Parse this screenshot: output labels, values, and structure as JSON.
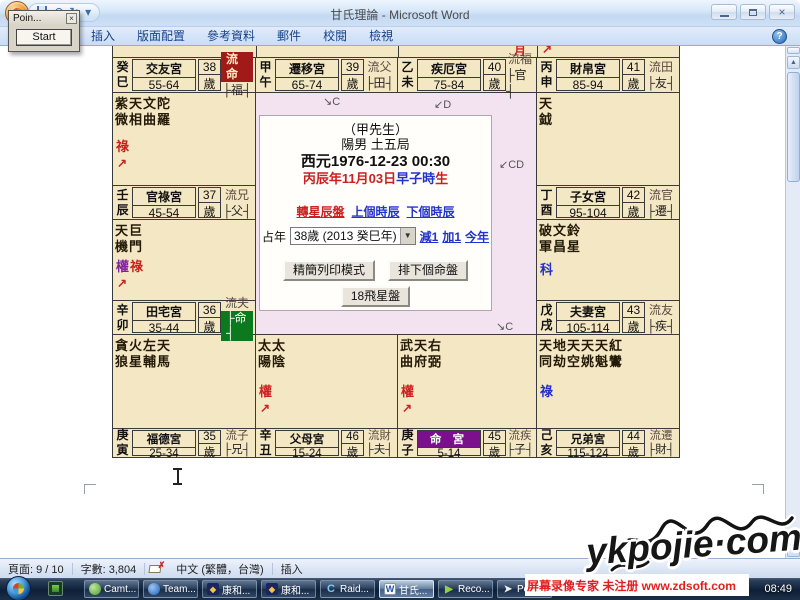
{
  "window": {
    "title": "甘氏理論 - Microsoft Word"
  },
  "popup": {
    "title": "Poin...",
    "start_button": "Start"
  },
  "ribbon": {
    "tabs": [
      "插入",
      "版面配置",
      "參考資料",
      "郵件",
      "校閱",
      "檢視"
    ],
    "help": "?"
  },
  "icons": {
    "undo": "↶",
    "redo": "↻",
    "qat_more": "▾",
    "close": "×",
    "popup_close": "×",
    "select_dropdown": "▼",
    "scroll_up": "▲",
    "scroll_down": "▼",
    "proofing_x": "✗",
    "kanghe_glyph": "◆",
    "raid_glyph": "C",
    "word_glyph": "W",
    "recorder_glyph": "▶",
    "pointer_glyph": "➤"
  },
  "chart": {
    "colors": {
      "cell_bg": "#f4e7c3",
      "center_bg": "#f3e3f1",
      "liu_highlight": "#a11a1a",
      "tag_highlight": "#0b7a1f",
      "name_highlight": "#7b0f8e"
    },
    "overflow_marks": [
      "月",
      "↗"
    ],
    "fly_marks": [
      "↘C",
      "↙D",
      "↙CD",
      "↘C"
    ],
    "palaces": [
      {
        "stem": "癸",
        "branch": "巳",
        "name": "交友宮",
        "range": "55-64",
        "age": "38",
        "age_unit": "歲",
        "liu": "流命",
        "liu_highlight": true,
        "tag": "├福┤"
      },
      {
        "stem": "甲",
        "branch": "午",
        "name": "遷移宮",
        "range": "65-74",
        "age": "39",
        "age_unit": "歲",
        "liu": "流父",
        "tag": "├田┤"
      },
      {
        "stem": "乙",
        "branch": "未",
        "name": "疾厄宮",
        "range": "75-84",
        "age": "40",
        "age_unit": "歲",
        "liu": "流福",
        "tag": "├官┤"
      },
      {
        "stem": "丙",
        "branch": "申",
        "name": "財帛宮",
        "range": "85-94",
        "age": "41",
        "age_unit": "歲",
        "liu": "流田",
        "tag": "├友┤"
      },
      {
        "stem": "壬",
        "branch": "辰",
        "name": "官祿宮",
        "range": "45-54",
        "age": "37",
        "age_unit": "歲",
        "liu": "流兄",
        "tag": "├父┤",
        "stars1": "紫天文陀",
        "stars2": "微相曲羅",
        "hua": [
          {
            "t": "祿",
            "c": "#cc2020"
          }
        ],
        "arrow": "↗"
      },
      {
        "stem": "丁",
        "branch": "酉",
        "name": "子女宮",
        "range": "95-104",
        "age": "42",
        "age_unit": "歲",
        "liu": "流官",
        "tag": "├遷┤",
        "stars1": "天",
        "stars2": "鉞"
      },
      {
        "stem": "辛",
        "branch": "卯",
        "name": "田宅宮",
        "range": "35-44",
        "age": "36",
        "age_unit": "歲",
        "liu": "流夫",
        "tag": "├命┤",
        "tag_highlight": true,
        "stars1": "天巨",
        "stars2": "機門",
        "hua": [
          {
            "t": "權",
            "c": "#8020a0"
          },
          {
            "t": "祿",
            "c": "#cc2020"
          }
        ],
        "arrow": "↗"
      },
      {
        "stem": "戊",
        "branch": "戌",
        "name": "夫妻宮",
        "range": "105-114",
        "age": "43",
        "age_unit": "歲",
        "liu": "流友",
        "tag": "├疾┤",
        "stars1": "破文鈴",
        "stars2": "軍昌星",
        "hua": [
          {
            "t": "科",
            "c": "#2130c8"
          }
        ]
      },
      {
        "stem": "庚",
        "branch": "寅",
        "name": "福德宮",
        "range": "25-34",
        "age": "35",
        "age_unit": "歲",
        "liu": "流子",
        "tag": "├兄┤",
        "stars1": "貪火左天",
        "stars2": "狼星輔馬"
      },
      {
        "stem": "辛",
        "branch": "丑",
        "name": "父母宮",
        "range": "15-24",
        "age": "46",
        "age_unit": "歲",
        "liu": "流財",
        "tag": "├夫┤",
        "stars1": "太太",
        "stars2": "陽陰",
        "hua": [
          {
            "t": "權",
            "c": "#cc2020"
          }
        ],
        "arrow": "↗"
      },
      {
        "stem": "庚",
        "branch": "子",
        "name": "命 宮",
        "range": "5-14",
        "age": "45",
        "age_unit": "歲",
        "liu": "流疾",
        "tag": "├子┤",
        "name_highlight": true,
        "stars1": "武天右",
        "stars2": "曲府弼",
        "hua": [
          {
            "t": "權",
            "c": "#cc2020"
          }
        ],
        "arrow": "↗"
      },
      {
        "stem": "己",
        "branch": "亥",
        "name": "兄弟宮",
        "range": "115-124",
        "age": "44",
        "age_unit": "歲",
        "liu": "流遷",
        "tag": "├財┤",
        "stars1": "天地天天天紅",
        "stars2": "同劫空姚魁鸞",
        "hua": [
          {
            "t": "祿",
            "c": "#2130c8"
          }
        ]
      }
    ]
  },
  "dialog": {
    "line1": "（甲先生）",
    "line2": "陽男 土五局",
    "line3": "西元1976-12-23 00:30",
    "line4_red1": "丙辰年11月03日",
    "line4_blue": "早子時",
    "line4_red2": "生",
    "links": [
      "轉星辰盤",
      "上個時辰",
      "下個時辰"
    ],
    "zhan_label": "占年",
    "select_value": "38歲 (2013 癸巳年)",
    "adjust_links": [
      "減1",
      "加1",
      "今年"
    ],
    "buttons": [
      "精簡列印模式",
      "排下個命盤",
      "18飛星盤"
    ]
  },
  "statusbar": {
    "page": "頁面: 9 / 10",
    "words": "字數: 3,804",
    "lang": "中文 (繁體，台灣)",
    "insert": "插入"
  },
  "taskbar": {
    "items": [
      {
        "label": "Camt..."
      },
      {
        "label": "Team..."
      },
      {
        "label": "康和..."
      },
      {
        "label": "康和..."
      },
      {
        "label": "Raid..."
      },
      {
        "label": "甘氏...",
        "active": true
      },
      {
        "label": "Reco..."
      },
      {
        "label": "Poin..."
      }
    ],
    "clock": "08:49"
  },
  "watermarks": {
    "big": "ykpojie·com",
    "recorder": "屏幕录像专家 未注册 www.zdsoft.com"
  }
}
